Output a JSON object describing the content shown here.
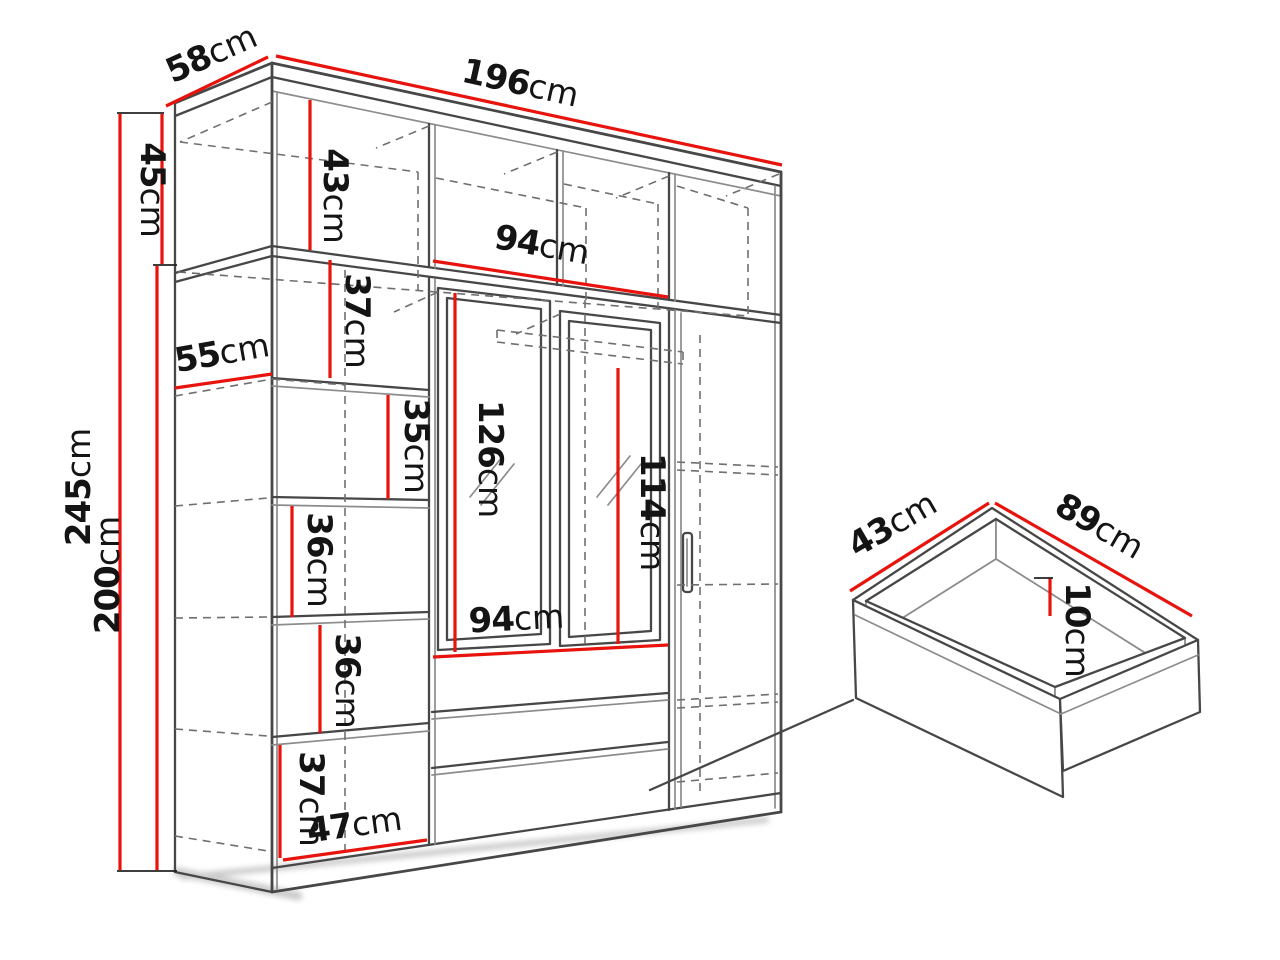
{
  "page": {
    "background": "#ffffff",
    "type": "furniture-dimension-diagram"
  },
  "colors": {
    "dimension_red": "#e8130c",
    "sketch_ink": "#474747",
    "sketch_light": "#8c8c8c",
    "hidden_dash": "#6f6f6f",
    "label_text": "#141414"
  },
  "wardrobe": {
    "dims": {
      "top_depth": {
        "v": "58",
        "u": "cm"
      },
      "width": {
        "v": "196",
        "u": "cm"
      },
      "upper_section_height": {
        "v": "45",
        "u": "cm"
      },
      "upper_inner_height": {
        "v": "43",
        "u": "cm"
      },
      "upper_inner_span": {
        "v": "94",
        "u": "cm"
      },
      "total_height": {
        "v": "245",
        "u": "cm"
      },
      "lower_section_height": {
        "v": "200",
        "u": "cm"
      },
      "upper_shelf_gap": {
        "v": "37",
        "u": "cm"
      },
      "lower_depth": {
        "v": "55",
        "u": "cm"
      },
      "shelf_gap_35": {
        "v": "35",
        "u": "cm"
      },
      "left_mirror_height": {
        "v": "126",
        "u": "cm"
      },
      "right_mirror_height": {
        "v": "114",
        "u": "cm"
      },
      "shelf_gap_36_upper": {
        "v": "36",
        "u": "cm"
      },
      "shelf_gap_36_lower": {
        "v": "36",
        "u": "cm"
      },
      "mirror_span": {
        "v": "94",
        "u": "cm"
      },
      "shelf_gap_37_bottom": {
        "v": "37",
        "u": "cm"
      },
      "shelf_column_width": {
        "v": "47",
        "u": "cm"
      }
    }
  },
  "drawer": {
    "dims": {
      "depth": {
        "v": "43",
        "u": "cm"
      },
      "width": {
        "v": "89",
        "u": "cm"
      },
      "height": {
        "v": "10",
        "u": "cm"
      }
    }
  }
}
